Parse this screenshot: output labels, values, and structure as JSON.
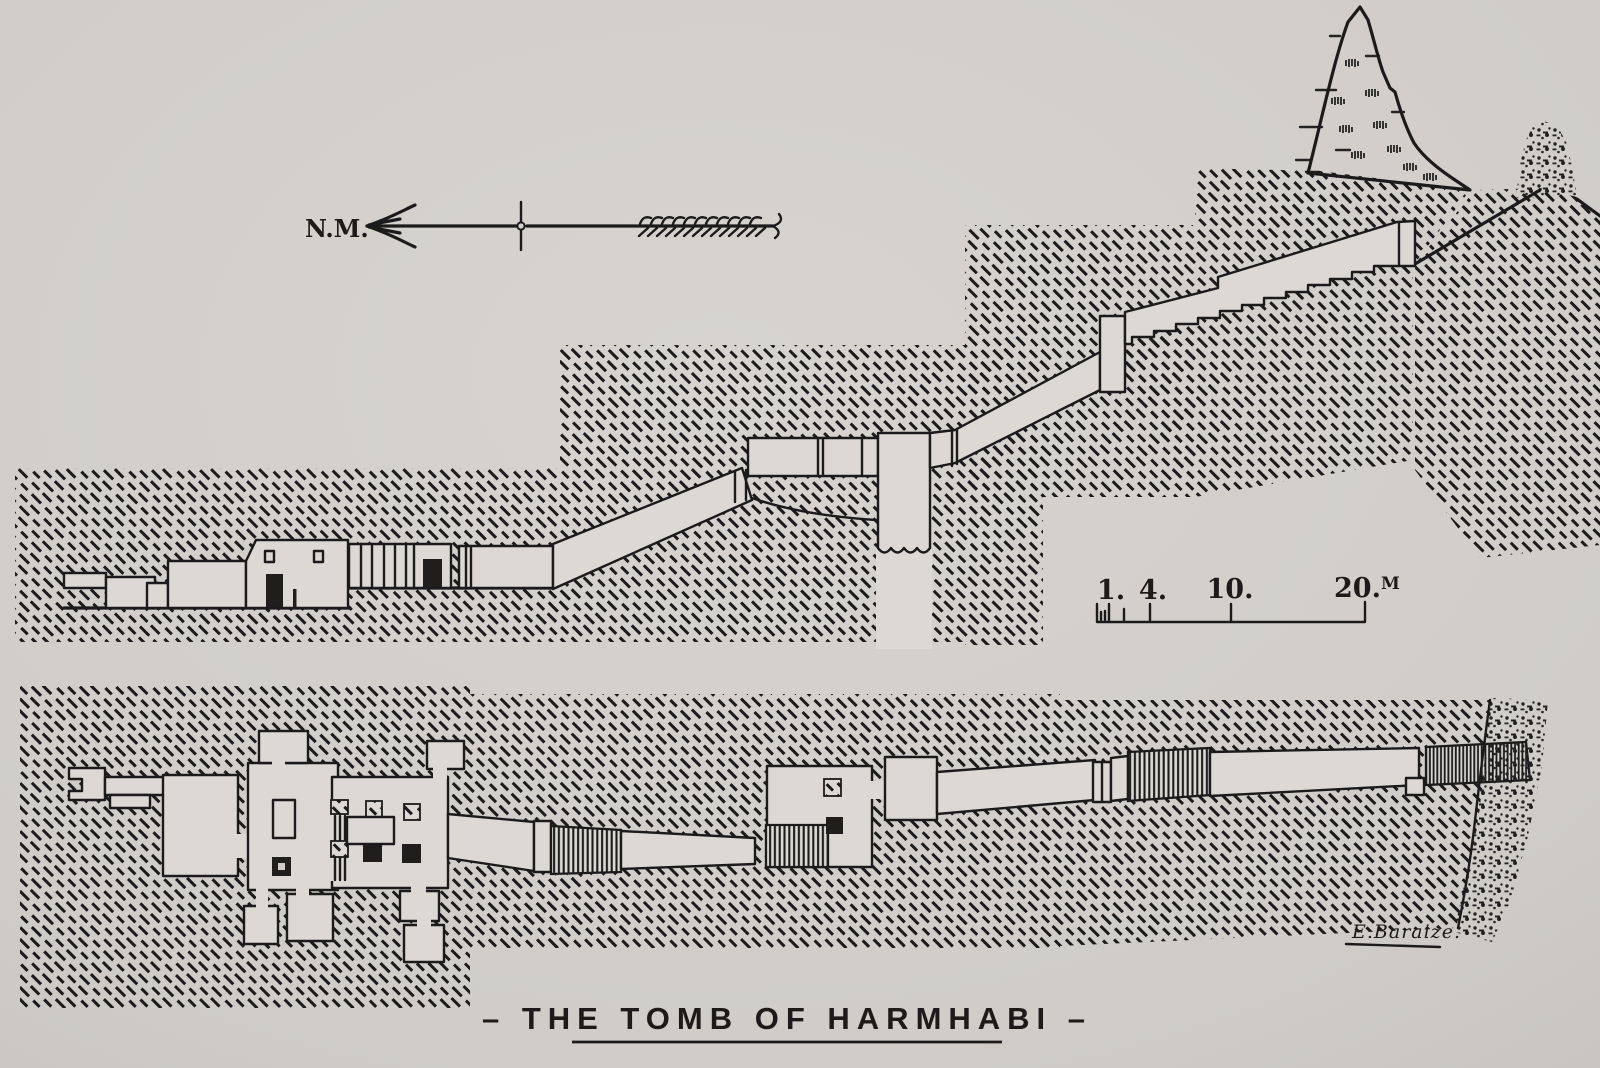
{
  "figure": {
    "title_display": "– THE TOMB OF HARMHABI –",
    "signature": "E.Baraize."
  },
  "north_arrow": {
    "label": "N.M."
  },
  "scale_bar": {
    "labels": [
      "1.",
      "4.",
      "10.",
      "20."
    ],
    "unit": "M"
  },
  "palette": {
    "paper": "#d2cfcb",
    "paper_light": "#dcd9d5",
    "ink": "#1b1b1b"
  }
}
